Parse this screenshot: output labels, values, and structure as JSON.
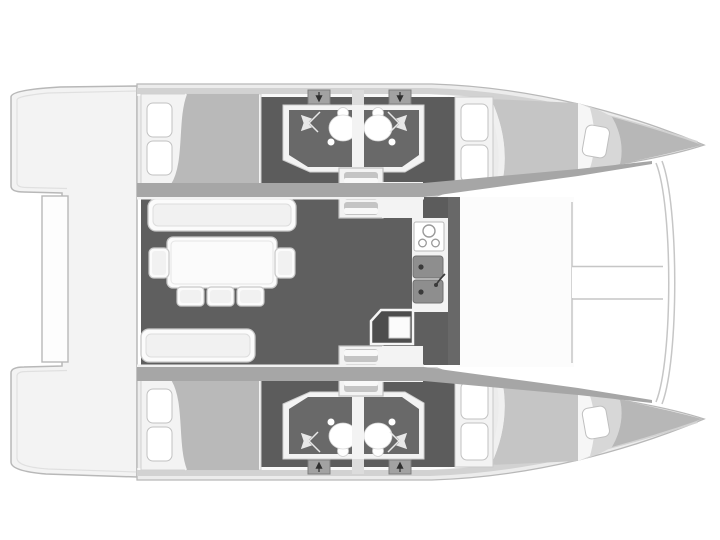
{
  "diagram": {
    "type": "boat-floor-plan",
    "subject": "catamaran-deck-and-cabin-layout",
    "orientation": "bow-right-stern-left",
    "symmetry": "mirrored-hulls-top-bottom"
  },
  "colors": {
    "background": "#ffffff",
    "outline": "#b8b8b8",
    "platform": "#f3f3f3",
    "beamPanel": "#fdfdfd",
    "hull": "#ececec",
    "deckBand": "#d2d2d2",
    "gunwale": "#a6a6a6",
    "interior": "#fafafa",
    "interiorDark": "#5c5c5c",
    "salonFloor": "#5f5f5f",
    "bulkhead": "#686868",
    "compartment": "#696969",
    "fixtureWhite": "#ffffff",
    "blanketAft": "#b9b9b9",
    "blanketFwd": "#c5c5c5",
    "bowWedge": "#b7b7b7",
    "forepeak": "#d7d7d7",
    "furniture": "#fbfbfb",
    "furnitureStroke": "#c9c9c9",
    "furnitureInner": "#f1f1f1",
    "counter": "#f3f3f3",
    "appliance": "#4d4d4d",
    "sink": "#8e8e8e",
    "sinkDot": "#3a3a3a",
    "hatch": "#a2a2a2",
    "stepDark": "#c4c4c4",
    "stepLight": "#f8f8f8",
    "foredeck": "#fcfcfc",
    "line": "#c6c6c6",
    "arrowLight": "#e8e8e8",
    "arrowDark": "#2f2f2f"
  },
  "legend": {
    "hulls": [
      {
        "name": "port",
        "cabins": [
          {
            "position": "aft",
            "type": "double-berth",
            "pillows": 2
          },
          {
            "position": "forward",
            "type": "double-berth",
            "pillows": 2
          },
          {
            "position": "forepeak",
            "type": "single-berth",
            "pillows": 1
          }
        ],
        "bathrooms": [
          {
            "toilet": true,
            "shower": true
          },
          {
            "toilet": true,
            "shower": true
          }
        ],
        "companionway_steps": 3,
        "escape_hatches": 2
      },
      {
        "name": "starboard",
        "cabins": [
          {
            "position": "aft",
            "type": "double-berth",
            "pillows": 2
          },
          {
            "position": "forward",
            "type": "double-berth",
            "pillows": 2
          },
          {
            "position": "forepeak",
            "type": "single-berth",
            "pillows": 1
          }
        ],
        "bathrooms": [
          {
            "toilet": true,
            "shower": true
          },
          {
            "toilet": true,
            "shower": true
          }
        ],
        "companionway_steps": 3,
        "escape_hatches": 2
      }
    ],
    "salon": {
      "dining_chairs": 5,
      "long_bench": 1,
      "sofa": 1,
      "galley_burners": 3,
      "galley_sinks": 2
    },
    "exterior": {
      "aft_platform": true,
      "trampoline_crossbeam": true,
      "bowsprit_band": true
    }
  }
}
